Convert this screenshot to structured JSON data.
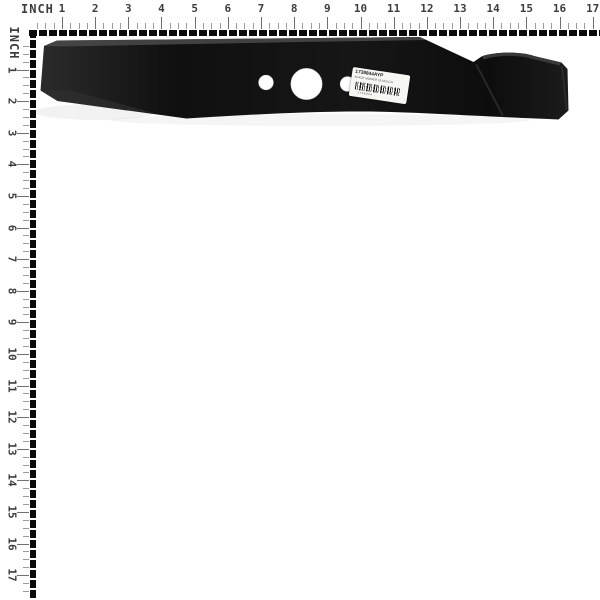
{
  "image_type": "product-photo-on-measurement-board",
  "background_color": "#ffffff",
  "rulers": {
    "unit_label": "INCH",
    "top": {
      "numbers": [
        "1",
        "2",
        "3",
        "4",
        "5",
        "6",
        "7",
        "8",
        "9",
        "10",
        "11",
        "12",
        "13",
        "14",
        "15",
        "16",
        "17"
      ]
    },
    "left": {
      "numbers": [
        "1",
        "2",
        "3",
        "4",
        "5",
        "6",
        "7",
        "8",
        "9",
        "10",
        "11",
        "12",
        "13",
        "14",
        "15",
        "16",
        "17"
      ]
    }
  },
  "product": {
    "name": "lawn-mower-blade",
    "blade_color": "#141414",
    "hole_color": "#ffffff",
    "label": {
      "part_number": "1738844AYP",
      "description": "BLADE MOWER 18 MULCH",
      "barcode_text": "1738844"
    }
  }
}
